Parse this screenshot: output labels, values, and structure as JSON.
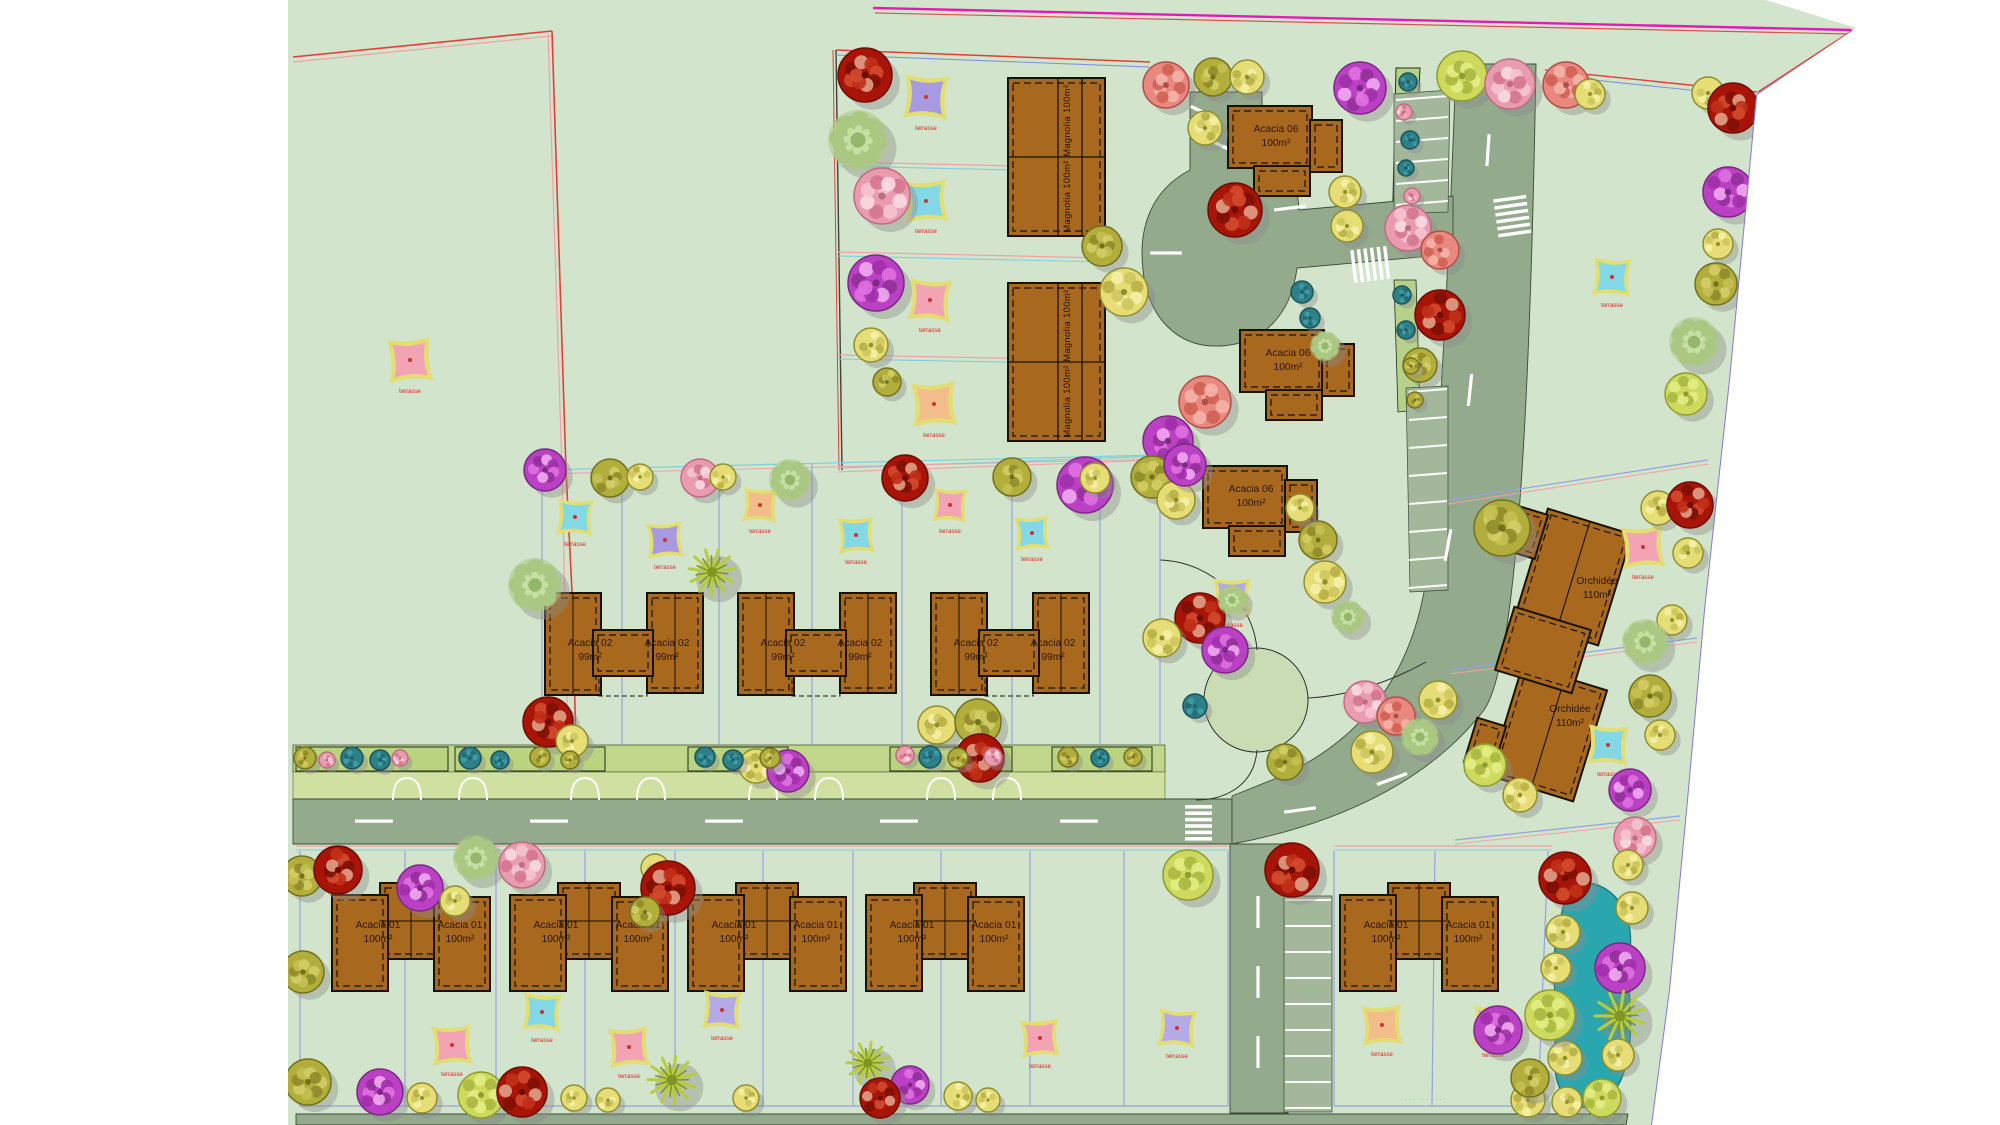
{
  "plan": {
    "colors": {
      "ground": "#d2e5cc",
      "road": "#94aa8c",
      "parking": "#a3b89b",
      "verge_hedge": "#c2d68b",
      "verge_drive": "#cfe0a0",
      "pond": "#2aa6af",
      "building": "#a8681e",
      "boundary_red": "#e04038",
      "boundary_pink": "#f2a0a8",
      "boundary_cyan": "#7fd0dc",
      "boundary_periwinkle": "#96a0e2",
      "boundary_magenta": "#e31ab8",
      "boundary_purple": "#8578d8",
      "sail_border": "#e3de72"
    },
    "street_label": "··········",
    "sail_label": "terrasse",
    "sail_colors": [
      "#a79ae0",
      "#82d8e4",
      "#f2a4b4",
      "#f2bd8a",
      "#b3aae6"
    ],
    "sails": [
      [
        410,
        360,
        22,
        2,
        -4
      ],
      [
        926,
        97,
        22,
        0,
        3
      ],
      [
        926,
        201,
        21,
        1,
        -3
      ],
      [
        930,
        300,
        21,
        2,
        4
      ],
      [
        934,
        404,
        22,
        3,
        -3
      ],
      [
        1612,
        277,
        19,
        1,
        3
      ],
      [
        1643,
        547,
        21,
        2,
        -4
      ],
      [
        1608,
        745,
        20,
        1,
        3
      ],
      [
        1232,
        597,
        19,
        4,
        0
      ],
      [
        575,
        517,
        18,
        1,
        3
      ],
      [
        665,
        540,
        18,
        0,
        -4
      ],
      [
        760,
        505,
        17,
        3,
        3
      ],
      [
        856,
        535,
        18,
        1,
        -3
      ],
      [
        950,
        505,
        17,
        2,
        3
      ],
      [
        1032,
        533,
        17,
        1,
        -3
      ],
      [
        452,
        1045,
        20,
        2,
        -3
      ],
      [
        542,
        1012,
        19,
        1,
        3
      ],
      [
        629,
        1047,
        20,
        2,
        -4
      ],
      [
        722,
        1010,
        19,
        4,
        3
      ],
      [
        1040,
        1038,
        19,
        2,
        -3
      ],
      [
        1177,
        1028,
        19,
        4,
        4
      ],
      [
        1382,
        1025,
        20,
        3,
        -3
      ],
      [
        1493,
        1026,
        20,
        4,
        3
      ]
    ],
    "buildings": {
      "magnolia": {
        "label": "Magnolia 100m²",
        "pairs": [
          [
            1008,
            78
          ],
          [
            1008,
            283
          ]
        ]
      },
      "acacia06": {
        "label": [
          "Acacia 06",
          "100m²"
        ],
        "sites": [
          [
            1228,
            106
          ],
          [
            1240,
            330
          ],
          [
            1203,
            466
          ]
        ]
      },
      "acacia02": {
        "label": [
          "Acacia 02",
          "99m²"
        ],
        "y": 593,
        "pair_x": [
          545,
          738,
          931
        ]
      },
      "acacia01": {
        "label": [
          "Acacia 01",
          "100m²"
        ],
        "y": 883,
        "pair_x": [
          332,
          510,
          688,
          866,
          1340
        ]
      },
      "orchidee": {
        "label": [
          "Orchidée",
          "110m²"
        ],
        "units": [
          [
            1573,
            577,
            17
          ],
          [
            1548,
            733,
            17
          ]
        ],
        "connector": [
          1543,
          650,
          17
        ]
      }
    },
    "tree_types": [
      {
        "name": "yellow-fruit-tree",
        "base": "#e7dd76",
        "dark": "#8f8f2e",
        "acc": [
          "#f4efa6",
          "#cdc65e",
          "#b7b046"
        ]
      },
      {
        "name": "red-flowering-tree",
        "base": "#a81408",
        "dark": "#6e0d04",
        "acc": [
          "#d24a2e",
          "#7e1006",
          "#e0a088",
          "#c03018"
        ]
      },
      {
        "name": "magenta-flowering-tree",
        "base": "#bb41c4",
        "dark": "#7c2884",
        "acc": [
          "#e070e0",
          "#92309a",
          "#f0a8f0",
          "#a030a8"
        ]
      },
      {
        "name": "pink-flowering-tree",
        "base": "#e99cb0",
        "dark": "#c06c80",
        "acc": [
          "#f5c4d0",
          "#d4768e",
          "#fadce2"
        ]
      },
      {
        "name": "salmon-flowering-tree",
        "base": "#e8887e",
        "dark": "#b05046",
        "acc": [
          "#f5b2a8",
          "#d06054"
        ]
      },
      {
        "name": "olive-tree",
        "base": "#b2ae3c",
        "dark": "#73711e",
        "acc": [
          "#d2ce66",
          "#8f8c2a",
          "#c5c052"
        ]
      },
      {
        "name": "light-green-lacy-tree",
        "base": "#abc883",
        "dark": "#7fa35a",
        "acc": [
          "#c6dfa2",
          "#93b86c"
        ]
      },
      {
        "name": "palm-tree",
        "base": "#b8cc3f",
        "dark": "#7f9422",
        "acc": []
      },
      {
        "name": "teal-bush",
        "base": "#2d7f88",
        "dark": "#1c545b",
        "acc": [
          "#3f9ea8",
          "#256c74"
        ]
      },
      {
        "name": "yellow-green-tree",
        "base": "#cdda5e",
        "dark": "#8f9c30",
        "acc": [
          "#e2ec84",
          "#aab840"
        ]
      }
    ],
    "trees": [
      [
        865,
        75,
        27,
        1
      ],
      [
        858,
        140,
        30,
        6
      ],
      [
        882,
        196,
        28,
        3
      ],
      [
        876,
        283,
        28,
        2
      ],
      [
        871,
        345,
        17,
        0
      ],
      [
        887,
        382,
        14,
        5
      ],
      [
        1124,
        292,
        24,
        0
      ],
      [
        1102,
        246,
        20,
        5
      ],
      [
        1168,
        441,
        25,
        2
      ],
      [
        1205,
        402,
        26,
        4
      ],
      [
        1152,
        477,
        21,
        5
      ],
      [
        1085,
        485,
        28,
        2
      ],
      [
        1213,
        77,
        19,
        5
      ],
      [
        1247,
        77,
        17,
        0
      ],
      [
        1166,
        85,
        23,
        4
      ],
      [
        1205,
        128,
        17,
        0
      ],
      [
        1235,
        210,
        27,
        1
      ],
      [
        1345,
        192,
        16,
        0
      ],
      [
        1347,
        226,
        16,
        0
      ],
      [
        1360,
        88,
        26,
        2
      ],
      [
        1462,
        76,
        25,
        9
      ],
      [
        1510,
        84,
        25,
        3
      ],
      [
        1566,
        85,
        23,
        4
      ],
      [
        1590,
        94,
        15,
        0
      ],
      [
        1708,
        93,
        16,
        0
      ],
      [
        1733,
        108,
        25,
        1
      ],
      [
        1728,
        192,
        25,
        2
      ],
      [
        1718,
        244,
        15,
        0
      ],
      [
        1716,
        284,
        21,
        5
      ],
      [
        1694,
        342,
        25,
        6
      ],
      [
        1686,
        394,
        21,
        9
      ],
      [
        1408,
        228,
        23,
        3
      ],
      [
        1440,
        250,
        19,
        4
      ],
      [
        1440,
        315,
        25,
        1
      ],
      [
        1420,
        365,
        17,
        5
      ],
      [
        1302,
        292,
        11,
        8
      ],
      [
        1310,
        318,
        10,
        8
      ],
      [
        1325,
        346,
        15,
        6
      ],
      [
        1176,
        500,
        19,
        0
      ],
      [
        1318,
        540,
        19,
        5
      ],
      [
        1300,
        508,
        14,
        0
      ],
      [
        545,
        470,
        21,
        2
      ],
      [
        610,
        478,
        19,
        5
      ],
      [
        640,
        477,
        13,
        0
      ],
      [
        700,
        478,
        19,
        3
      ],
      [
        723,
        477,
        13,
        0
      ],
      [
        790,
        480,
        21,
        6
      ],
      [
        905,
        478,
        23,
        1
      ],
      [
        1012,
        477,
        19,
        5
      ],
      [
        1095,
        478,
        15,
        0
      ],
      [
        1185,
        465,
        21,
        2
      ],
      [
        712,
        572,
        23,
        7
      ],
      [
        535,
        585,
        27,
        6
      ],
      [
        548,
        722,
        25,
        1
      ],
      [
        572,
        741,
        16,
        0
      ],
      [
        756,
        766,
        17,
        0
      ],
      [
        788,
        771,
        21,
        2
      ],
      [
        937,
        725,
        19,
        0
      ],
      [
        978,
        722,
        23,
        5
      ],
      [
        980,
        758,
        24,
        1
      ],
      [
        1200,
        618,
        25,
        1
      ],
      [
        1225,
        650,
        23,
        2
      ],
      [
        1162,
        638,
        19,
        0
      ],
      [
        1232,
        600,
        15,
        6
      ],
      [
        1325,
        582,
        21,
        0
      ],
      [
        1348,
        617,
        17,
        6
      ],
      [
        1365,
        702,
        21,
        3
      ],
      [
        1396,
        716,
        19,
        4
      ],
      [
        1420,
        737,
        19,
        6
      ],
      [
        1372,
        752,
        21,
        0
      ],
      [
        1438,
        700,
        19,
        0
      ],
      [
        1195,
        706,
        12,
        8
      ],
      [
        1285,
        762,
        18,
        5
      ],
      [
        305,
        758,
        11,
        5
      ],
      [
        327,
        760,
        8,
        3
      ],
      [
        352,
        758,
        11,
        8
      ],
      [
        380,
        760,
        10,
        8
      ],
      [
        400,
        758,
        8,
        3
      ],
      [
        470,
        758,
        11,
        8
      ],
      [
        500,
        760,
        9,
        8
      ],
      [
        540,
        757,
        10,
        5
      ],
      [
        570,
        760,
        9,
        5
      ],
      [
        705,
        757,
        10,
        8
      ],
      [
        733,
        760,
        10,
        8
      ],
      [
        770,
        758,
        10,
        5
      ],
      [
        905,
        755,
        9,
        3
      ],
      [
        930,
        757,
        11,
        8
      ],
      [
        958,
        758,
        10,
        5
      ],
      [
        993,
        757,
        9,
        3
      ],
      [
        1068,
        757,
        10,
        5
      ],
      [
        1100,
        758,
        9,
        8
      ],
      [
        1133,
        757,
        9,
        5
      ],
      [
        1408,
        82,
        9,
        8
      ],
      [
        1404,
        112,
        8,
        3
      ],
      [
        1410,
        140,
        9,
        8
      ],
      [
        1406,
        168,
        8,
        8
      ],
      [
        1412,
        196,
        8,
        3
      ],
      [
        1402,
        295,
        9,
        8
      ],
      [
        1406,
        330,
        9,
        8
      ],
      [
        1411,
        366,
        8,
        5
      ],
      [
        1415,
        400,
        8,
        5
      ],
      [
        302,
        876,
        20,
        5
      ],
      [
        338,
        870,
        24,
        1
      ],
      [
        303,
        972,
        21,
        5
      ],
      [
        420,
        888,
        23,
        2
      ],
      [
        455,
        901,
        15,
        0
      ],
      [
        476,
        858,
        23,
        6
      ],
      [
        522,
        865,
        23,
        3
      ],
      [
        655,
        868,
        14,
        0
      ],
      [
        668,
        888,
        27,
        1
      ],
      [
        645,
        912,
        15,
        5
      ],
      [
        1188,
        875,
        25,
        9
      ],
      [
        1292,
        870,
        27,
        1
      ],
      [
        308,
        1082,
        23,
        5
      ],
      [
        380,
        1092,
        23,
        2
      ],
      [
        422,
        1098,
        15,
        0
      ],
      [
        481,
        1095,
        23,
        9
      ],
      [
        522,
        1092,
        25,
        1
      ],
      [
        574,
        1098,
        13,
        0
      ],
      [
        608,
        1100,
        12,
        0
      ],
      [
        672,
        1080,
        24,
        7
      ],
      [
        746,
        1098,
        13,
        0
      ],
      [
        868,
        1063,
        21,
        7
      ],
      [
        910,
        1085,
        19,
        2
      ],
      [
        880,
        1098,
        20,
        1
      ],
      [
        958,
        1096,
        14,
        0
      ],
      [
        988,
        1100,
        12,
        0
      ],
      [
        1565,
        878,
        26,
        1
      ],
      [
        1635,
        838,
        21,
        3
      ],
      [
        1563,
        932,
        17,
        0
      ],
      [
        1556,
        968,
        15,
        0
      ],
      [
        1565,
        1058,
        17,
        0
      ],
      [
        1567,
        1102,
        15,
        0
      ],
      [
        1628,
        865,
        15,
        0
      ],
      [
        1632,
        908,
        16,
        0
      ],
      [
        1620,
        968,
        25,
        2
      ],
      [
        1620,
        1016,
        25,
        7
      ],
      [
        1618,
        1055,
        16,
        0
      ],
      [
        1550,
        1015,
        25,
        9
      ],
      [
        1498,
        1030,
        24,
        2
      ],
      [
        1528,
        1100,
        17,
        0
      ],
      [
        1530,
        1078,
        19,
        5
      ],
      [
        1602,
        1098,
        19,
        9
      ],
      [
        1502,
        528,
        28,
        5
      ],
      [
        1658,
        508,
        17,
        0
      ],
      [
        1690,
        505,
        23,
        1
      ],
      [
        1688,
        553,
        15,
        0
      ],
      [
        1672,
        620,
        15,
        0
      ],
      [
        1645,
        642,
        23,
        6
      ],
      [
        1650,
        696,
        21,
        5
      ],
      [
        1660,
        735,
        15,
        0
      ],
      [
        1630,
        790,
        21,
        2
      ],
      [
        1485,
        765,
        21,
        9
      ],
      [
        1520,
        795,
        17,
        0
      ]
    ]
  }
}
